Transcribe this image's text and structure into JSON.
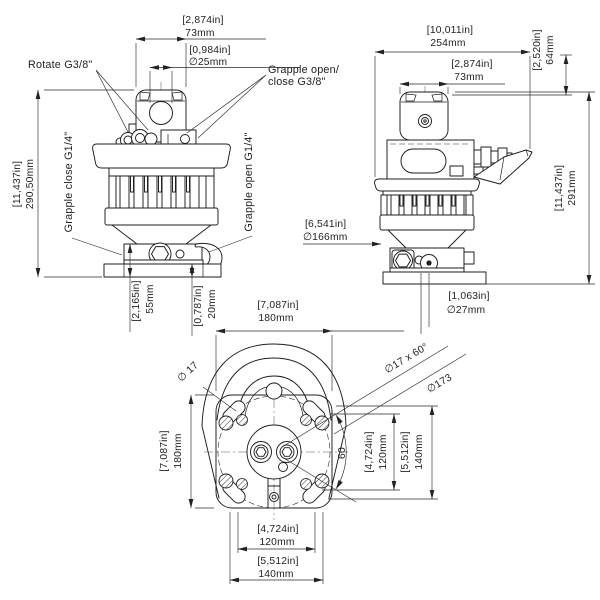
{
  "labels": {
    "rotate": "Rotate G3/8\"",
    "grapple_open_close_1": "Grapple open/",
    "grapple_open_close_2": "close G3/8\"",
    "grapple_close": "Grapple close G1/4\"",
    "grapple_open": "Grapple open G1/4\""
  },
  "front_view": {
    "width": {
      "in": "[2,874in]",
      "mm": "73mm"
    },
    "pin_hole": {
      "in": "[0,984in]",
      "mm": "∅25mm"
    },
    "height": {
      "in": "[11,437in]",
      "mm": "290,50mm"
    },
    "bracket_height": {
      "in": "[2,165in]",
      "mm": "55mm"
    },
    "base_thickness": {
      "in": "[0,787in]",
      "mm": "20mm"
    }
  },
  "side_view": {
    "overall_width": {
      "in": "[10,011in]",
      "mm": "254mm"
    },
    "housing_width": {
      "in": "[2,874in]",
      "mm": "73mm"
    },
    "handle_height": {
      "in": "[2,520in]",
      "mm": "64mm"
    },
    "height": {
      "in": "[11,437in]",
      "mm": "291mm"
    },
    "flange_dia": {
      "in": "[6,541in]",
      "mm": "∅166mm"
    },
    "hole_dia": {
      "in": "[1,063in]",
      "mm": "∅27mm"
    }
  },
  "bottom_view": {
    "width": {
      "in": "[7,087in]",
      "mm": "180mm"
    },
    "height": {
      "in": "[7,087in]",
      "mm": "180mm"
    },
    "slot_dia": "∅ 17",
    "hole_pattern": "∅17 x 60°",
    "bolt_circle": "∅173",
    "angle": "60",
    "spacing_h_inner": {
      "in": "[4,724in]",
      "mm": "120mm"
    },
    "spacing_h_outer": {
      "in": "[5,512in]",
      "mm": "140mm"
    },
    "spacing_v_inner": {
      "in": "[4,724in]",
      "mm": "120mm"
    },
    "spacing_v_outer": {
      "in": "[5,512in]",
      "mm": "140mm"
    }
  }
}
